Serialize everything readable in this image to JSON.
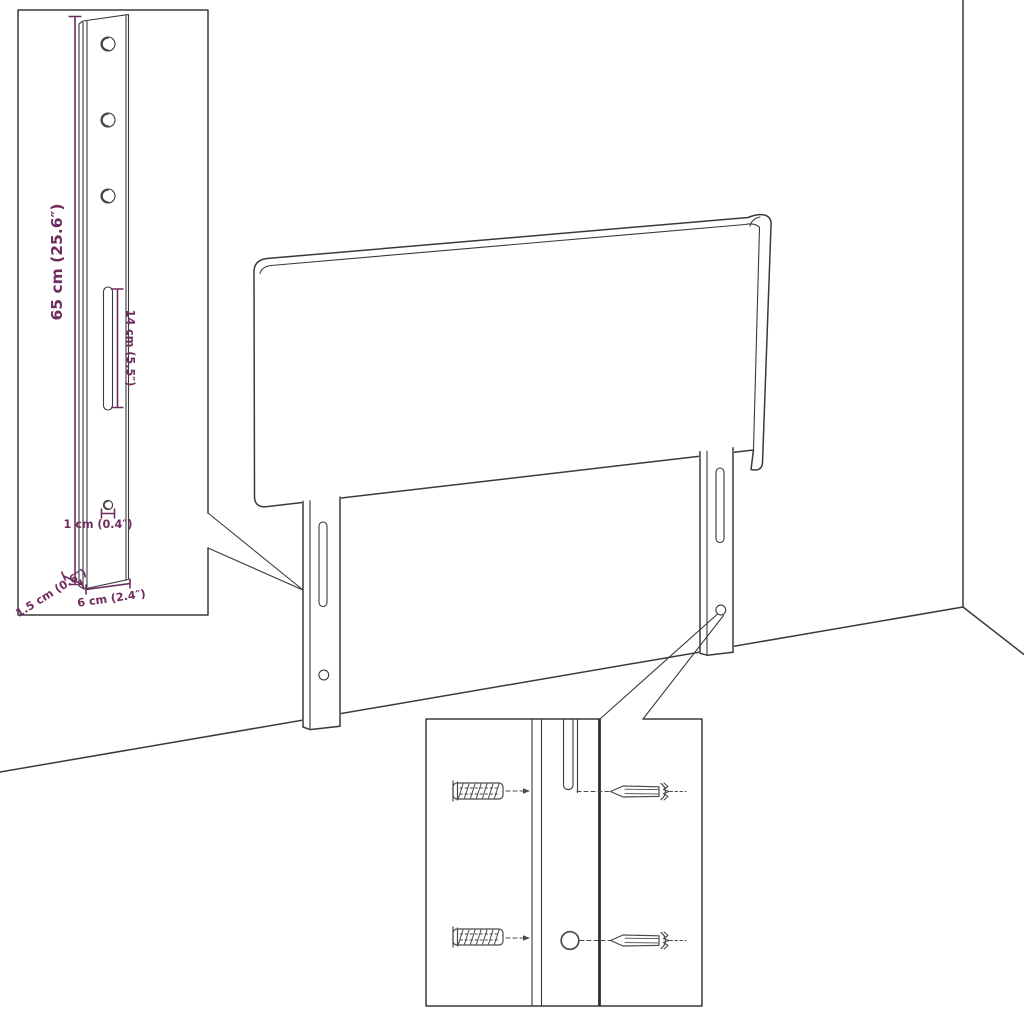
{
  "diagram": {
    "background": "#ffffff",
    "line_color": "#3a3a3a",
    "dimension_color": "#6f2c5f",
    "subject": "headboard with mounting legs, wall corner, leg-detail inset and wall-fixing hardware inset"
  },
  "bracket_detail_inset": {
    "dimensions": {
      "height": "65 cm (25.6″)",
      "slot_length": "14 cm (5.5″)",
      "hole_diameter": "1 cm (0.4″)",
      "width": "6 cm (2.4″)",
      "thickness": "1.5 cm (0.6″)"
    },
    "holes_count": 3
  },
  "hardware_inset": {
    "parts": [
      "wall-plug",
      "screw",
      "leg-slot",
      "leg-hole"
    ]
  }
}
